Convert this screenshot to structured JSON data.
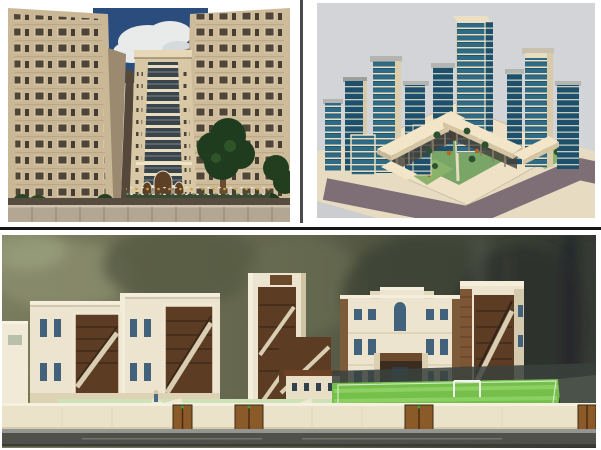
{
  "page": {
    "title": "Architectural 3D renderings collage",
    "background": "#ffffff"
  },
  "dividers": {
    "vertical": "#4b4b4b",
    "horizontal": "#161616"
  },
  "panels": {
    "towers": {
      "alt": "Worm's-eye 3D rendering of beige residential high-rise towers flanking a central tower with arched entrance, blue sky with clouds above, trees, flower bed and boundary wall at street level",
      "colors": {
        "sky": "#2b4d7e",
        "cloud": "#f3f4f0",
        "facade": "#c9b795",
        "facadeInner": "#9b8a6f",
        "towerFace": "#d9c8a6",
        "glass": "#39444b",
        "band": "#e6dcc0",
        "arch": "#5e4026",
        "tree": "#203c1e",
        "fence": "#b3a693",
        "shadow": "#564c40"
      }
    },
    "city": {
      "alt": "Isometric 3D rendering of an urban block: blue glass towers around a tall central high-rise and a U-shaped cream podium courtyard, mauve roads with cream sidewalks and small lawns with trees",
      "colors": {
        "bg": "#d2d4d7",
        "glass": "#2f6b85",
        "glassDark": "#1e4f6b",
        "band": "#e9dfc2",
        "podium": "#f3e5c8",
        "road": "#7e6e76",
        "sidewalk": "#e7dbc2",
        "plaza": "#eee1c6",
        "lawn": "#8ab26b",
        "court": "#79a566",
        "cap": "#b4b4b0"
      }
    },
    "campus": {
      "alt": "Street-level rendering of a cream campus building group with open stair atriums showing brown interiors, a green sports field with goal, low boundary wall with brown double gates and an asphalt road, blurred olive trees behind",
      "colors": {
        "treesLight": "#7a7c5e",
        "treesDark": "#2f342d",
        "building": "#ece4cf",
        "window": "#42617a",
        "stairwell": "#5d3c24",
        "stairRamp": "#d9cdb2",
        "brick": "#7d5636",
        "field": "#74c04b",
        "apron": "#cde3b6",
        "wall": "#ebe2ca",
        "gate": "#8a5a28",
        "road": "#50504b"
      }
    }
  }
}
